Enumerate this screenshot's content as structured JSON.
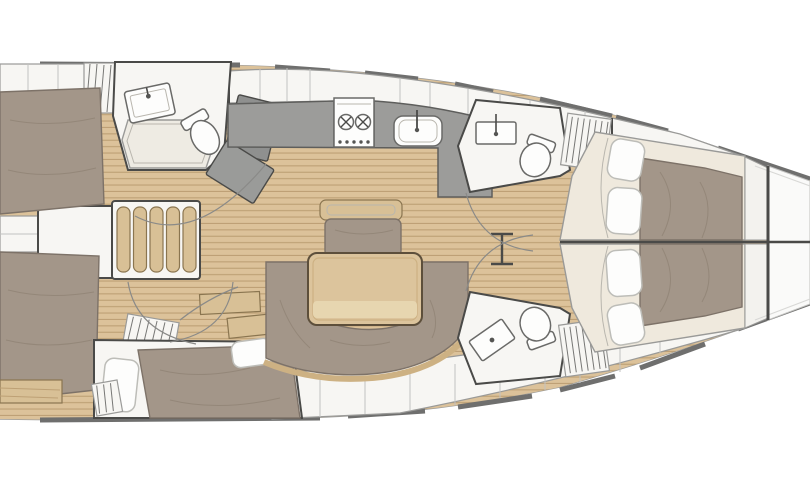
{
  "page": {
    "title": "Sailing yacht interior layout — top-down floor plan"
  },
  "diagram": {
    "type": "boat-floorplan",
    "view": "top-down",
    "bow_direction": "right",
    "stern_direction": "left",
    "rooms": [
      {
        "id": "aft-cabin-port",
        "label": "Aft cabin (top, stern)",
        "furniture": [
          "double berth",
          "hanging locker",
          "en-suite head with sink, toilet and shower pan",
          "door"
        ]
      },
      {
        "id": "aft-cabin-starboard",
        "label": "Aft cabin (bottom, stern)",
        "furniture": [
          "angled double berth with two pillows",
          "hanging locker",
          "wood shelves"
        ]
      },
      {
        "id": "companionway",
        "label": "Companionway",
        "furniture": [
          "five-tread wooden stairway",
          "engine compartment box",
          "transom step"
        ]
      },
      {
        "id": "galley",
        "label": "Galley (top, midship)",
        "furniture": [
          "L-shaped grey counter",
          "two-burner stove",
          "sink with faucet"
        ]
      },
      {
        "id": "salon",
        "label": "Salon (center)",
        "furniture": [
          "rectangular dining table",
          "C-shaped settee with wood trim",
          "bench seat with wood backrest",
          "mast compression post"
        ]
      },
      {
        "id": "fwd-head-top",
        "label": "Forward head (top)",
        "furniture": [
          "sink with faucet",
          "toilet",
          "hanging locker"
        ]
      },
      {
        "id": "fwd-head-bottom",
        "label": "Forward head (bottom)",
        "furniture": [
          "sink with faucet",
          "toilet",
          "hanging locker"
        ]
      },
      {
        "id": "fwd-cabin-top",
        "label": "Forward cabin (top)",
        "furniture": [
          "double berth with duvet",
          "two pillows",
          "foot shelf"
        ]
      },
      {
        "id": "fwd-cabin-bottom",
        "label": "Forward cabin (bottom)",
        "furniture": [
          "double berth with duvet",
          "two pillows",
          "foot shelf"
        ]
      }
    ],
    "counts": {
      "cabins": 4,
      "heads": 3,
      "pillows": 6,
      "stove_burners": 2,
      "companionway_treads": 5
    }
  },
  "colors": {
    "hull_fill": "#fafaf9",
    "hull_line": "#9b9b99",
    "inner_line": "#d8d8d6",
    "rail": "#6f6f6e",
    "wall_dark": "#4a4a48",
    "seam": "#c2c2c0",
    "floor_wood": "#dcc29a",
    "floor_stripe": "#bda075",
    "wood_furniture": "#d8c096",
    "wood_edge": "#8a7550",
    "upholstery": "#a39689",
    "upholstery_line": "#7d7268",
    "wrinkle": "#948779",
    "cream": "#efe9dd",
    "pillow": "#fdfdfc",
    "pillow_edge": "#bdbdb8",
    "white_room": "#f7f6f3",
    "room_line": "#9a9a98",
    "shower": "#eeebe3",
    "soft_line": "#b9b6ae",
    "counter": "#9c9c9a",
    "counter_edge": "#5e5e5c",
    "door": "#8f908f",
    "door2": "#9a9b99",
    "table_wood": "#dcc49c",
    "table_edge": "#5d4f3b",
    "table_band": "#e7d6b0",
    "trim": "#cdb183",
    "arc": "#8a8a88",
    "hatch": "#777775",
    "fixture_line": "#6a6a68",
    "shelf": "#f3f2ee"
  }
}
